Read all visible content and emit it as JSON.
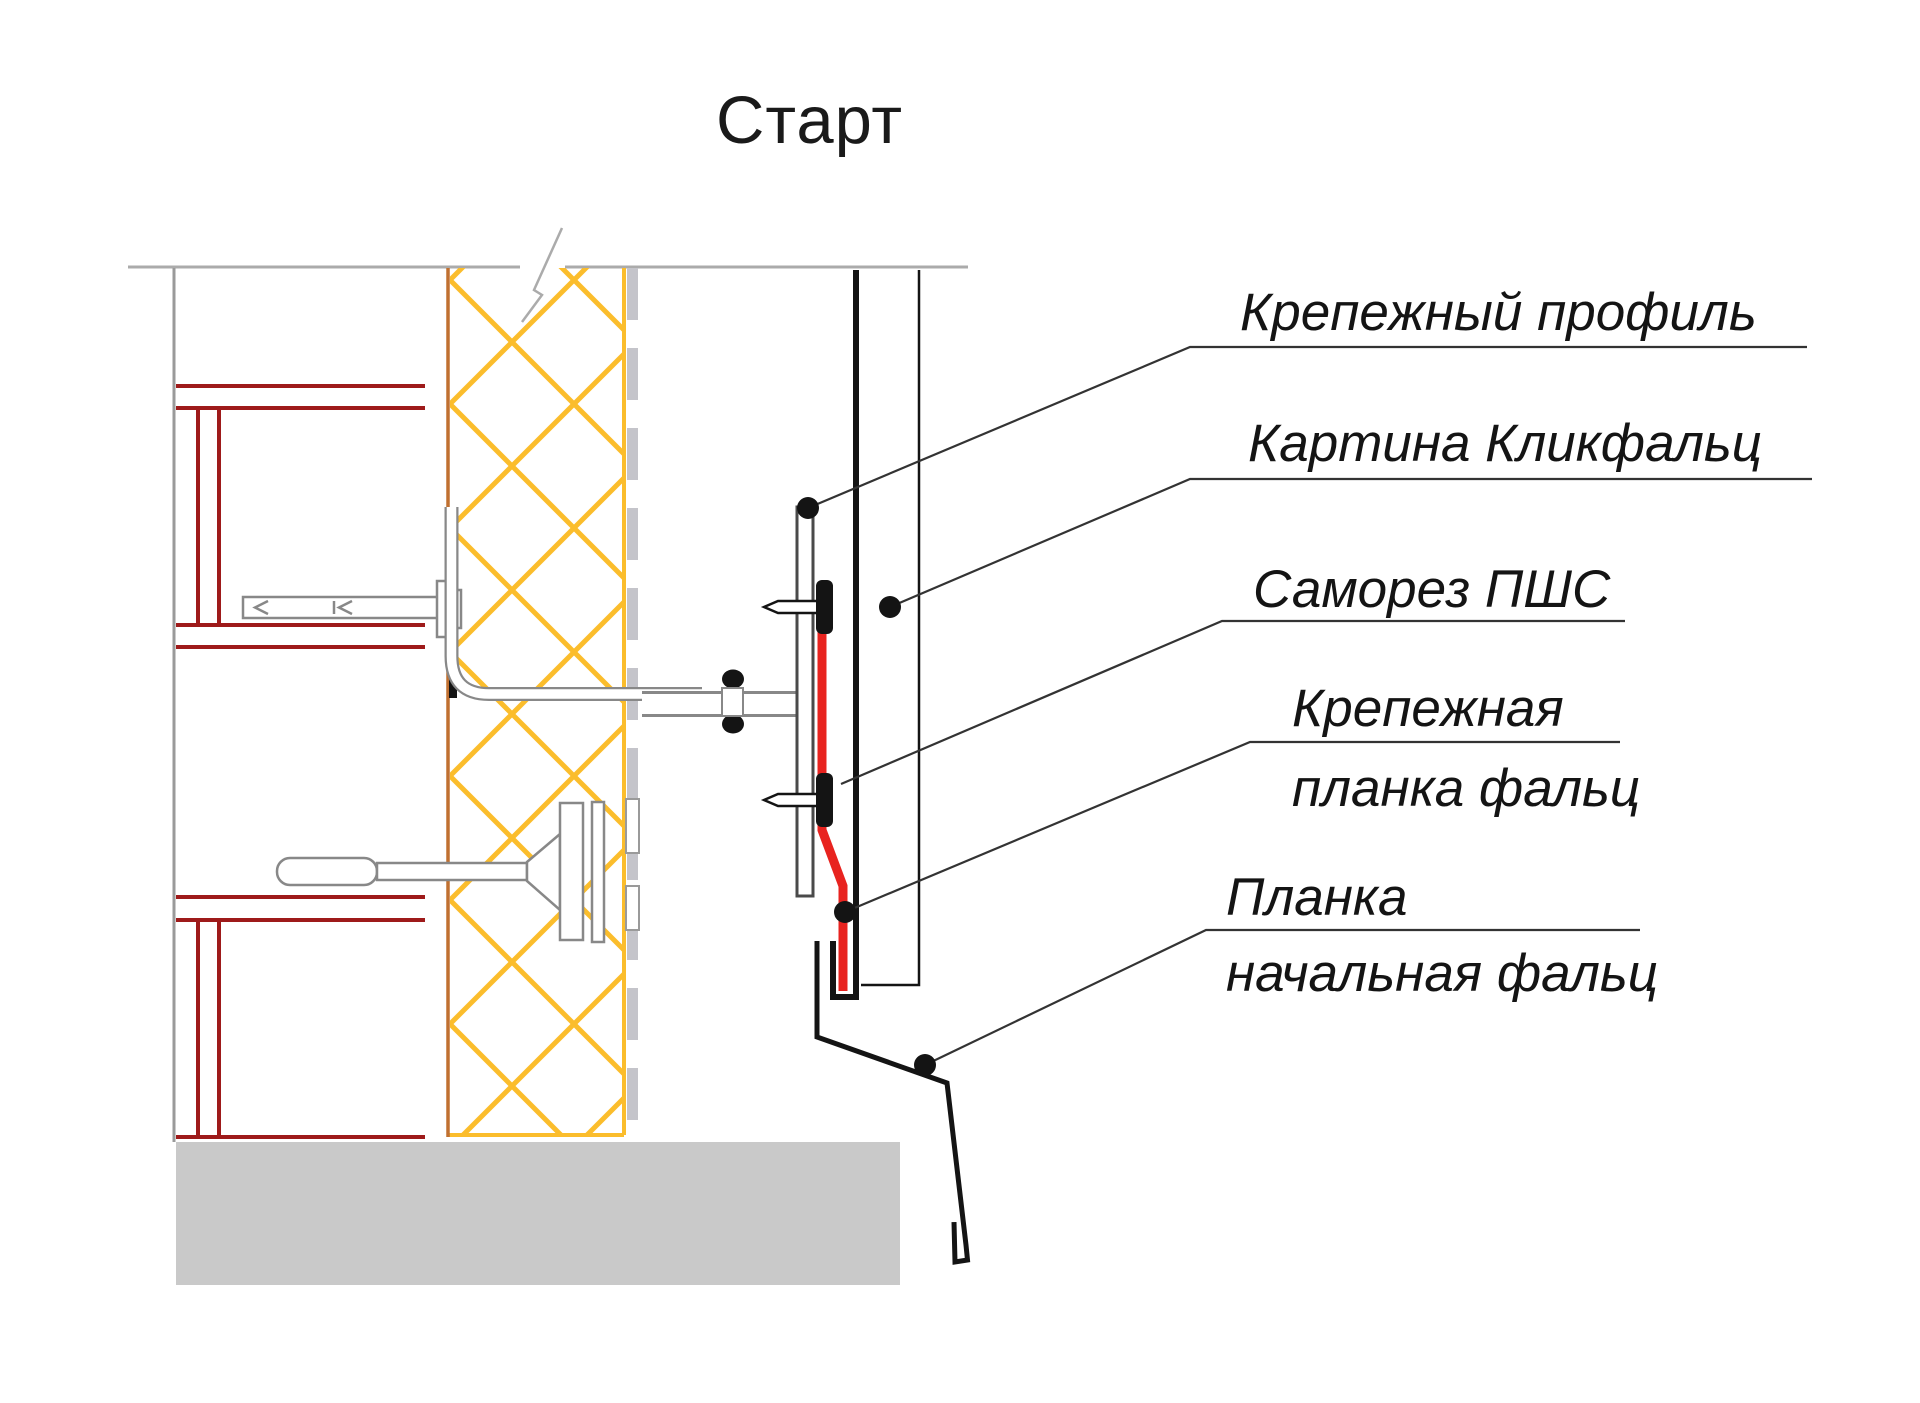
{
  "title": "Старт",
  "labels": {
    "mounting_profile": "Крепежный профиль",
    "panel": "Картина Кликфальц",
    "screw": "Саморез ПШС",
    "fastening_strip_line1": "Крепежная",
    "fastening_strip_line2": "планка фальц",
    "starting_strip_line1": "Планка",
    "starting_strip_line2": "начальная фальц"
  },
  "colors": {
    "insulation_hatch": "#FBBD2C",
    "wall_framing_red": "#9E1A1A",
    "wall_face_brown": "#C07030",
    "highlight_strip_red": "#E8231F",
    "panel_black": "#141414",
    "foundation_gray": "#C9C9C9",
    "membrane_gray": "#C4C4CA",
    "hardware_outline_gray": "#888888",
    "section_line_gray": "#ABABAB"
  }
}
